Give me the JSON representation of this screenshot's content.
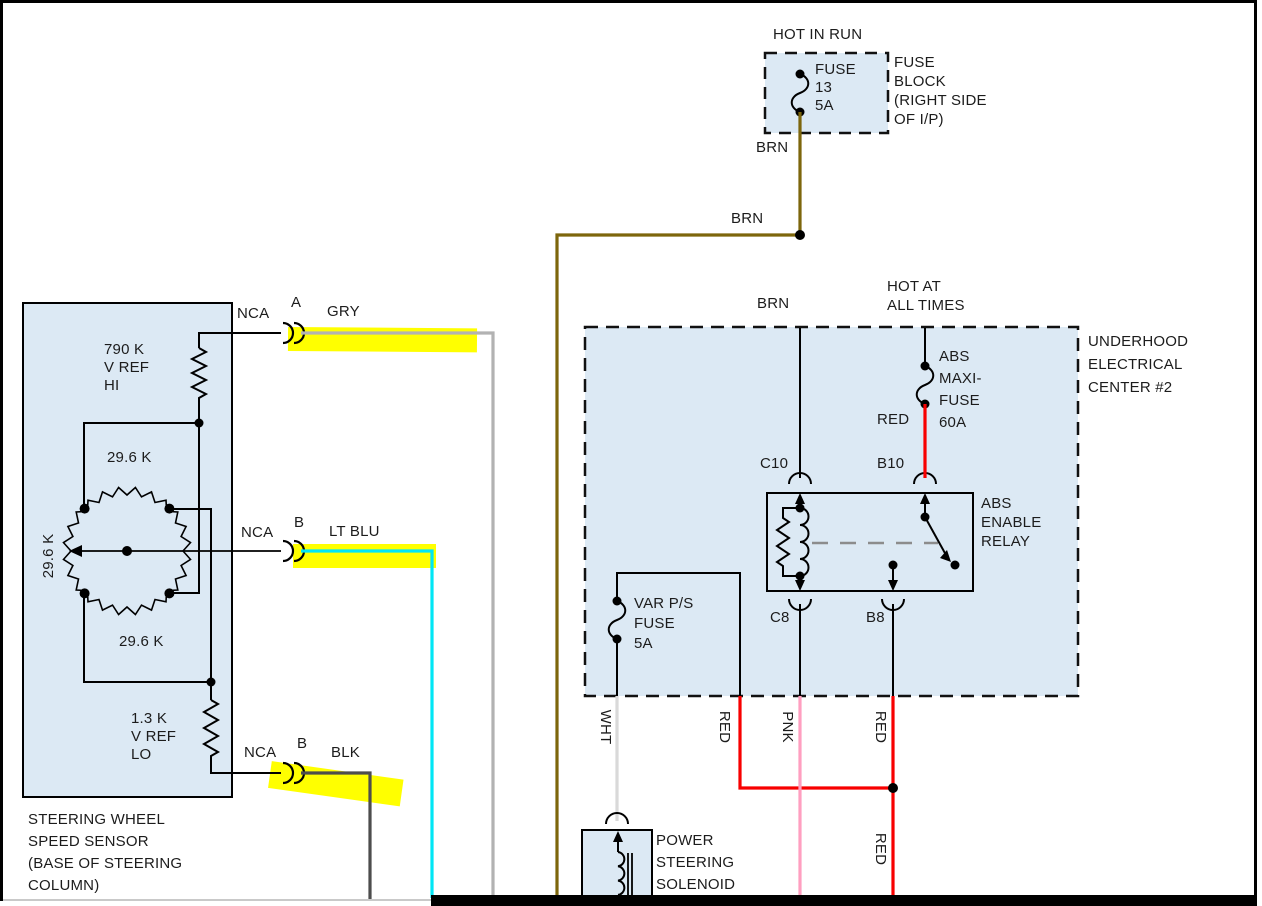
{
  "colors": {
    "brn": "#7d660c",
    "red": "#f80000",
    "pnk": "#ff9fc0",
    "wht": "#d9d9d9",
    "gry": "#b2b2b2",
    "blk": "#4d4d4d",
    "lt_blu": "#00e6f5",
    "highlight": "#ffff00",
    "component_fill": "#dce9f4"
  },
  "fuse_block": {
    "hot_label": "HOT IN RUN",
    "fuse": "FUSE\n13\n5A",
    "name": "FUSE\nBLOCK\n(RIGHT SIDE\nOF I/P)"
  },
  "wire_labels": {
    "brn": "BRN",
    "gry": "GRY",
    "lt_blu": "LT BLU",
    "blk": "BLK",
    "wht": "WHT",
    "red": "RED",
    "pnk": "PNK"
  },
  "underhood_center": {
    "hot_label": "HOT AT\nALL TIMES",
    "name": "UNDERHOOD\nELECTRICAL\nCENTER #2",
    "maxi_fuse": "ABS\nMAXI-\nFUSE\n60A",
    "relay_name": "ABS\nENABLE\nRELAY",
    "var_fuse": "VAR P/S\nFUSE\n5A",
    "terminals": {
      "c10": "C10",
      "b10": "B10",
      "c8": "C8",
      "b8": "B8"
    }
  },
  "sensor": {
    "name": "STEERING WHEEL\nSPEED SENSOR\n(BASE OF STEERING\nCOLUMN)",
    "r_high": "790 K\nV REF\nHI",
    "r_low": "1.3 K\nV REF\nLO",
    "ring_value": "29.6 K",
    "connectors": {
      "nca": "NCA",
      "pin_a": "A",
      "pin_b": "B"
    }
  },
  "solenoid": {
    "name": "POWER\nSTEERING\nSOLENOID\nACTUATOR"
  }
}
